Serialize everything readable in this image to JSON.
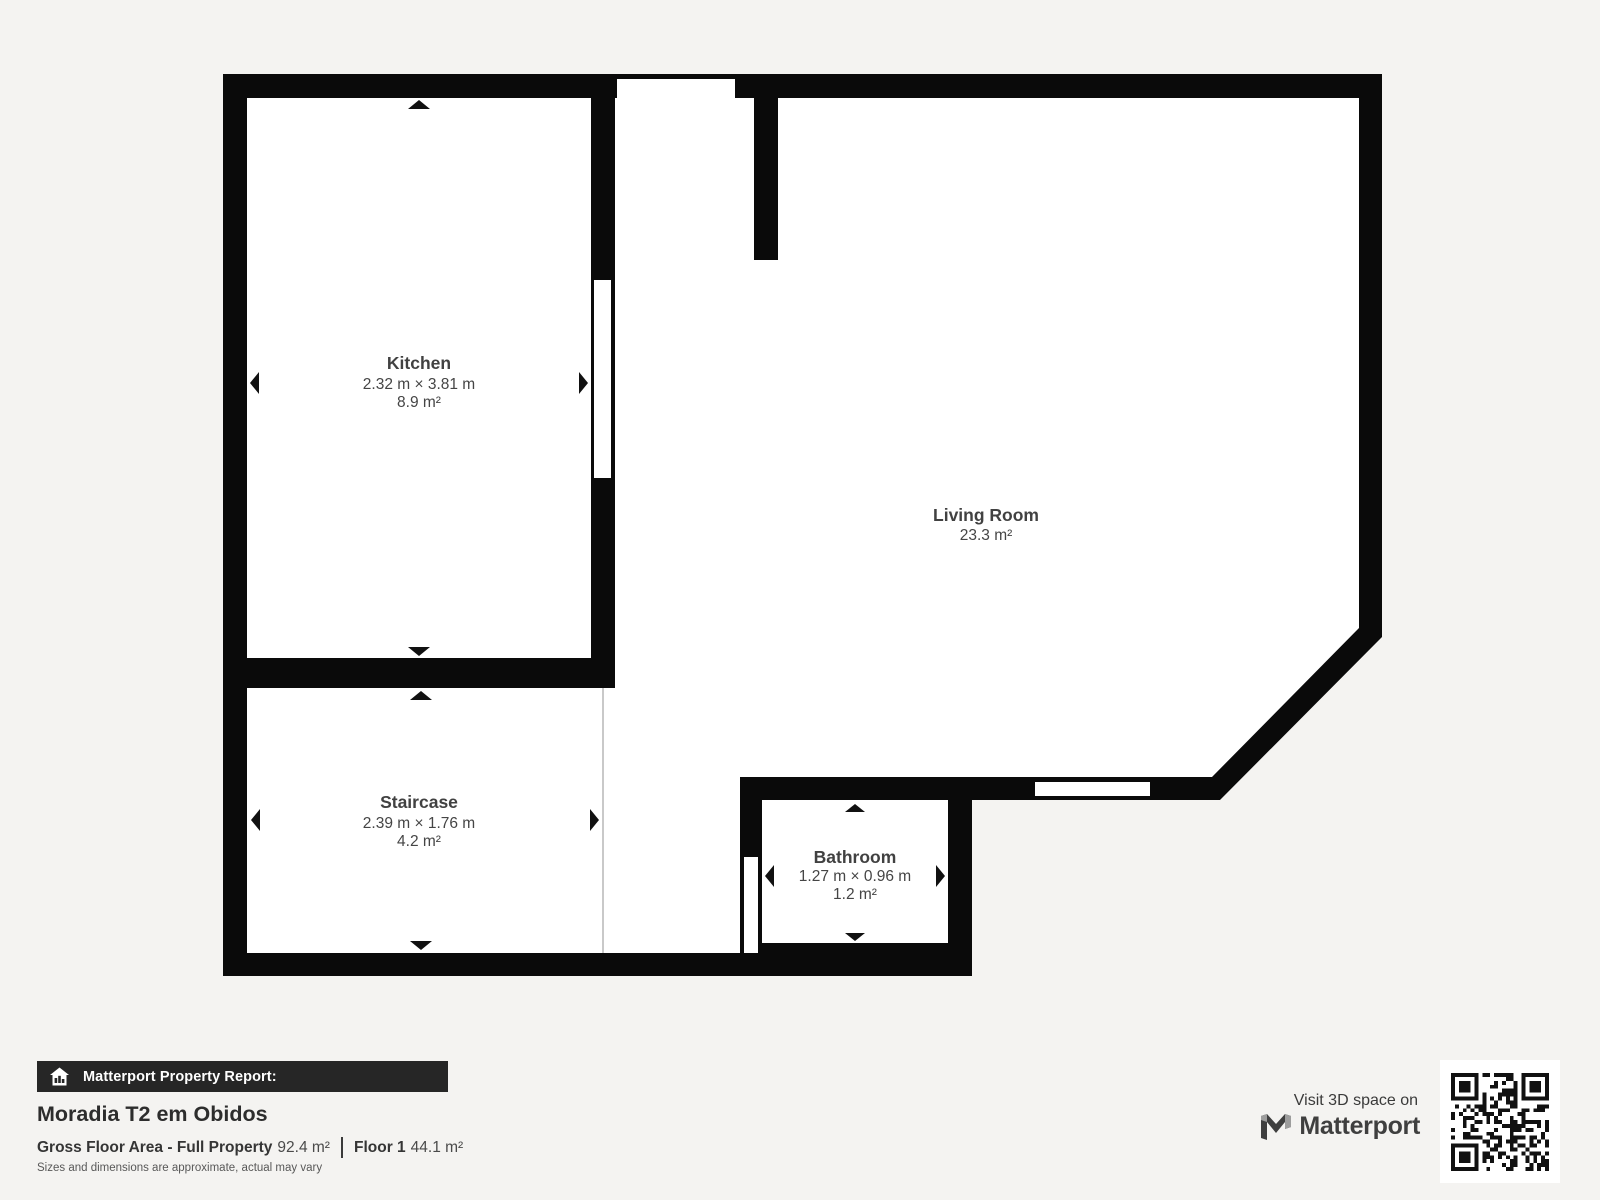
{
  "plan": {
    "rooms": [
      {
        "name": "Kitchen",
        "dimensions": "2.32 m × 3.81 m",
        "area": "8.9 m²"
      },
      {
        "name": "Living Room",
        "dimensions": "",
        "area": "23.3 m²"
      },
      {
        "name": "Staircase",
        "dimensions": "2.39 m × 1.76 m",
        "area": "4.2 m²"
      },
      {
        "name": "Bathroom",
        "dimensions": "1.27 m × 0.96 m",
        "area": "1.2 m²"
      }
    ]
  },
  "footer": {
    "report_label": "Matterport Property Report:",
    "property_title": "Moradia T2 em Obidos",
    "gfa_label": "Gross Floor Area - Full Property",
    "gfa_value": "92.4 m²",
    "floor_label": "Floor 1",
    "floor_value": "44.1 m²",
    "disclaimer": "Sizes and dimensions are approximate, actual may vary"
  },
  "promo": {
    "visit_text": "Visit 3D space on",
    "brand": "Matterport"
  },
  "colors": {
    "wall": "#0a0a0a",
    "floor": "#ffffff",
    "background": "#f4f3f1",
    "label_text": "#414141",
    "bar_background": "#262626",
    "thin_line": "#c9c9c9"
  }
}
